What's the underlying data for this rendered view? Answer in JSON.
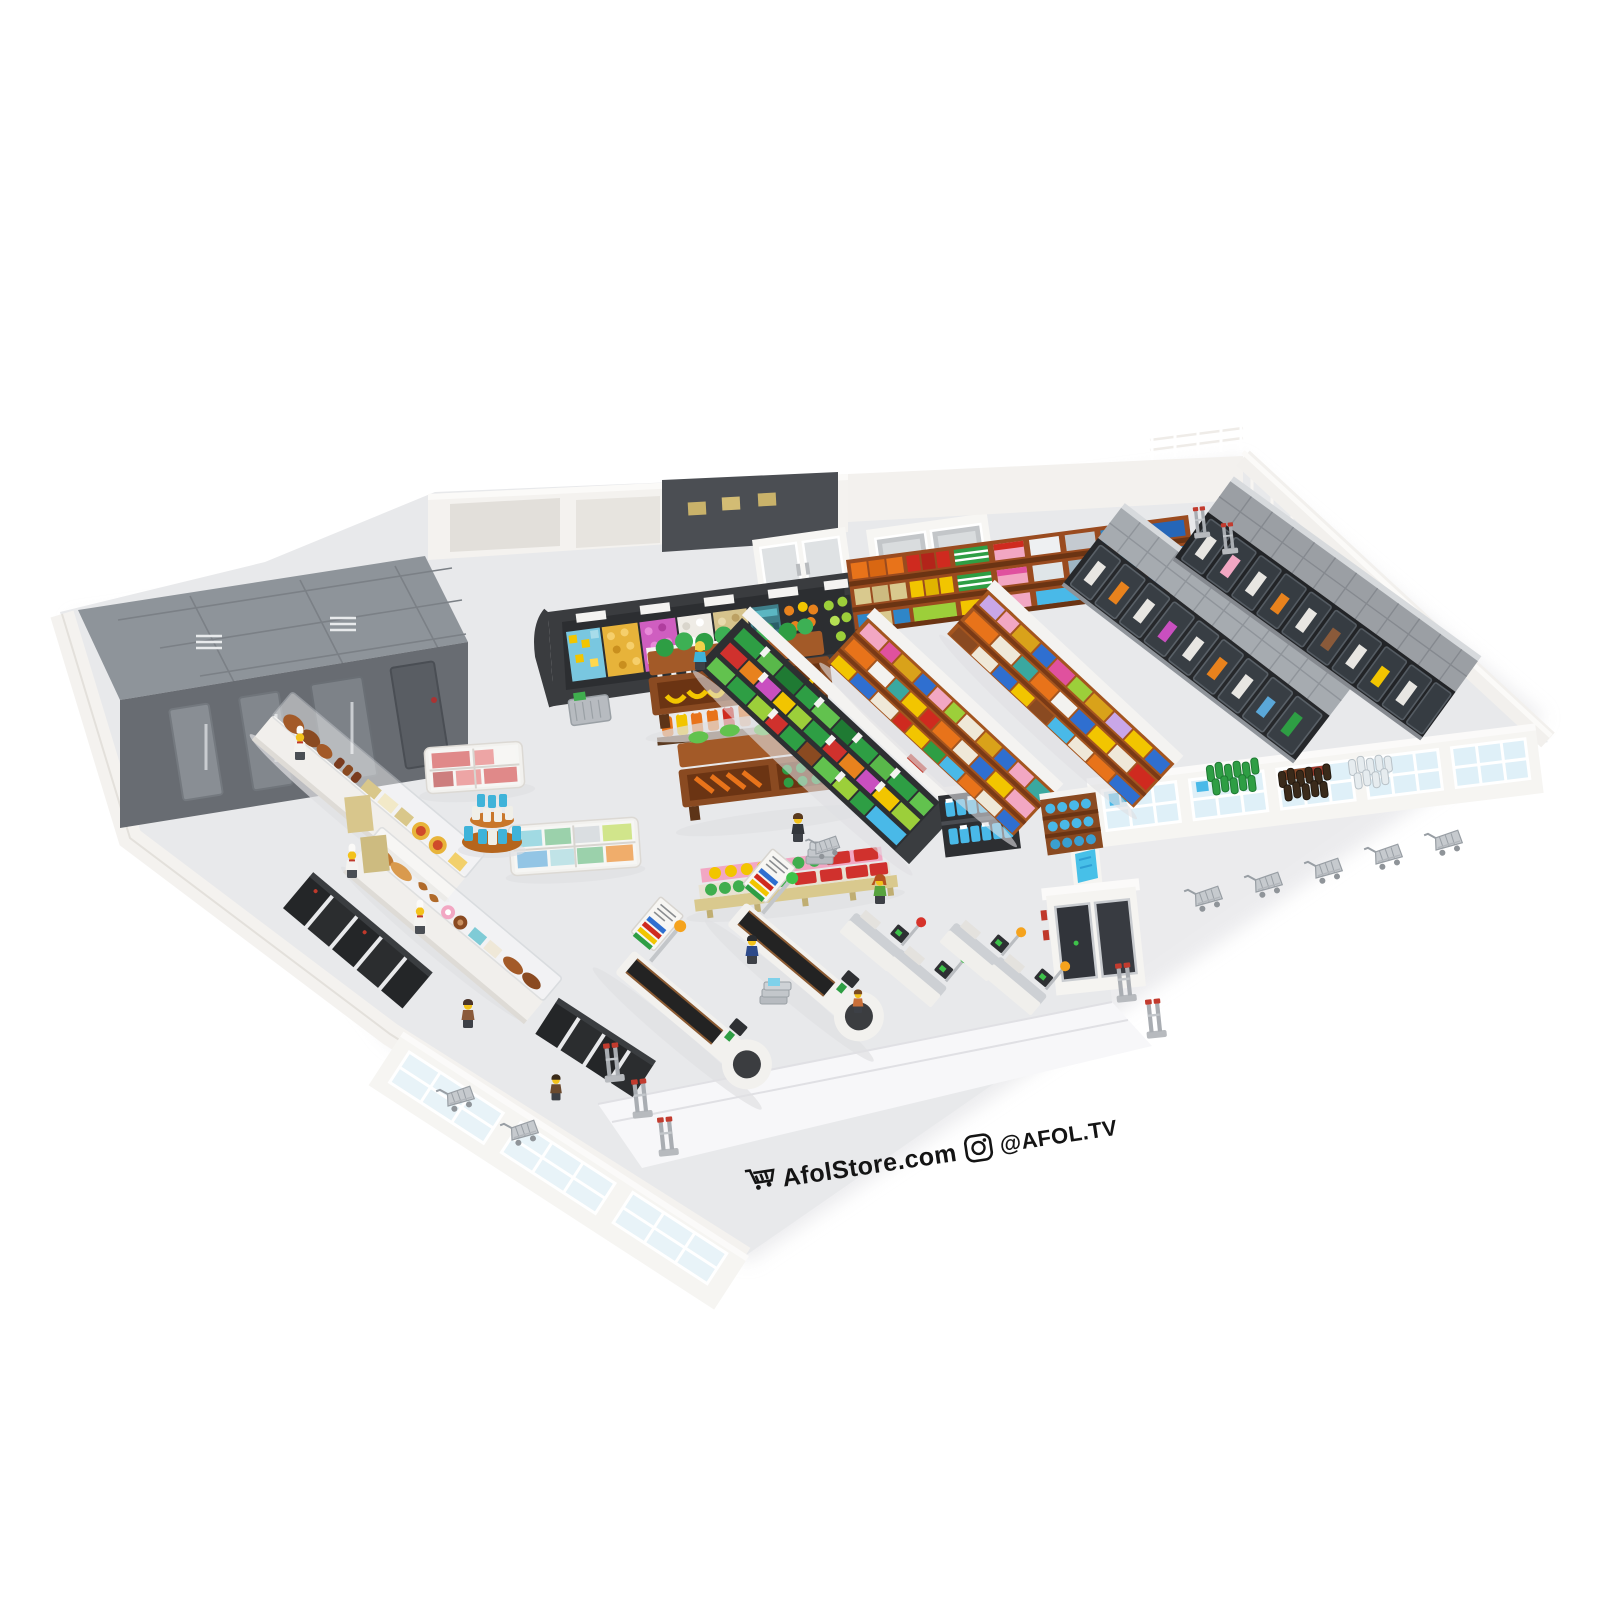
{
  "image": {
    "type": "3d-render",
    "subject": "LEGO supermarket interior model shown from an isometric bird's-eye view on a white background",
    "background_color": "#ffffff"
  },
  "branding": {
    "website": "AfolStore.com",
    "instagram_handle": "@AFOL.TV",
    "icons": [
      "shopping-cart-icon",
      "instagram-icon"
    ],
    "text_color": "#141414",
    "rotation_deg": -8.5
  },
  "palette": {
    "floor": "#e8e9eb",
    "walls": "#f5f4f1",
    "walkin_roof": "#8e949a",
    "fixture_dark": "#26282b",
    "shelf_wood": "#9a4b1f",
    "shelf_top_white": "#f4f3f1",
    "freezer_top": "#a6abb0",
    "window_glass": "#dff0f8",
    "accent_red": "#cf2a1f",
    "accent_orange": "#e8731a",
    "accent_yellow": "#f2c500",
    "accent_green": "#2e9e44",
    "accent_lime": "#9ccf3a",
    "accent_blue": "#2f6fd0",
    "accent_aqua": "#49b9e8",
    "accent_magenta": "#d857c4",
    "accent_pink": "#f2a7c3",
    "lane_light_green": "#3ec24a",
    "lane_light_orange": "#f5a31d",
    "lane_light_red": "#d6332a",
    "gate_red_cap": "#c23b2e",
    "minifig_skin": "#f3c21a"
  },
  "scene": {
    "back_of_store": [
      {
        "id": "walkin-freezer-room",
        "label": "walk-in cooler room with gray panel roof and stainless doors"
      },
      {
        "id": "back-rooms",
        "label": "white back rooms / stockroom with tan boxes and double doors"
      },
      {
        "id": "bakery-display",
        "label": "dark curved bakery wall case with colorful pastry grids"
      },
      {
        "id": "back-wall-shelf",
        "label": "wood wall shelving with boxed and bottled goods"
      }
    ],
    "center_of_store": [
      {
        "id": "condiment-shelf",
        "label": "sauce rack with mustard and ketchup bottles"
      },
      {
        "id": "deli-counters",
        "label": "glass deli and bakery counters with chefs"
      },
      {
        "id": "wall-ovens",
        "label": "black oven banks along the wall"
      },
      {
        "id": "chest-freezers",
        "label": "white chest freezer islands with sliding glass lids"
      },
      {
        "id": "round-display",
        "label": "round tiered can display"
      },
      {
        "id": "produce-stands",
        "label": "wooden produce stands with greens, bananas and carrots"
      },
      {
        "id": "produce-pallet",
        "label": "pallet with trays of fruit and vegetables"
      },
      {
        "id": "produce-fridge",
        "label": "open refrigerated produce wall case"
      },
      {
        "id": "gondola-aisles",
        "label": "two grocery gondola aisles with colorful products"
      }
    ],
    "right_of_store": [
      {
        "id": "freezer-rows",
        "label": "two rows of black glass-door freezer cases"
      },
      {
        "id": "beverage-bottles",
        "label": "floor display of green, brown and clear bottles"
      },
      {
        "id": "window-wall",
        "label": "white front wall with large windows"
      },
      {
        "id": "shopping-carts",
        "label": "row of gray shopping carts"
      },
      {
        "id": "bottle-return-machine",
        "label": "white machine with dark glass doors"
      }
    ],
    "front_of_store": [
      {
        "id": "checkout-lanes",
        "label": "two conveyor checkout lanes with striped signs and lane lights"
      },
      {
        "id": "self-checkouts",
        "label": "four self-checkout kiosks with status lights"
      },
      {
        "id": "security-gates",
        "label": "gray security gates with red caps"
      },
      {
        "id": "entrance-apron",
        "label": "white entrance walkway with curb"
      }
    ],
    "minifigures": [
      {
        "role": "produce-clerk",
        "torso": "#3fb3d9",
        "hair": "blonde"
      },
      {
        "role": "chef",
        "torso": "#f4f3f0",
        "hat": "white"
      },
      {
        "role": "chef",
        "torso": "#f4f3f0",
        "hat": "white"
      },
      {
        "role": "chef",
        "torso": "#f4f3f0",
        "hat": "white"
      },
      {
        "role": "butcher",
        "torso": "#8a5a3a"
      },
      {
        "role": "cashier",
        "torso": "#2d4a8a"
      },
      {
        "role": "customer-woman",
        "torso": "#57a33f",
        "hair": "dark-orange"
      },
      {
        "role": "customer-man",
        "torso": "#33363b"
      },
      {
        "role": "child",
        "torso": "#c9703a"
      }
    ]
  }
}
